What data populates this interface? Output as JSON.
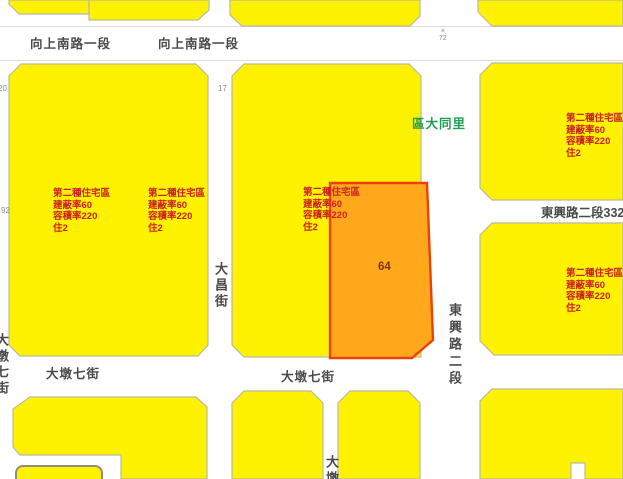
{
  "map": {
    "streets": {
      "xiangshang_label_1": "向上南路一段",
      "xiangshang_label_2": "向上南路一段",
      "dachang_street": "大昌街",
      "dadun7_label_left": "大墩七街",
      "dadun7_label_mid": "大墩七街",
      "dadun_bottom_partial": "大墩",
      "left_edge_street_partial": "大墩七街",
      "dongxing_sec2": "東興路二段",
      "dongxing_lane332": "東興路二段332巷"
    },
    "district_label": "區大同里",
    "zone_text": {
      "line1": "第二種住宅區",
      "line2": "建蔽率60",
      "line3": "容積率220",
      "line4": "住2"
    },
    "parcel_number": "64",
    "markers": {
      "left_top": "20",
      "mid_top": "17",
      "left_mid": "92",
      "road_tick": "×",
      "road_num": "72"
    }
  },
  "colors": {
    "zone_fill": "#fff200",
    "zone_stroke": "#b9b9a0",
    "parcel_fill": "#ffa81c",
    "parcel_stroke": "#f04000",
    "parcel_text": "#803300",
    "zone_text": "#cc2020",
    "street_text": "#4a4a4a",
    "district_text": "#1e9e55",
    "marker_text": "#8a8a8a",
    "road_edge": "#dcdcdc",
    "road_fill": "#ffffff",
    "outline_dark": "#8f8f78"
  }
}
